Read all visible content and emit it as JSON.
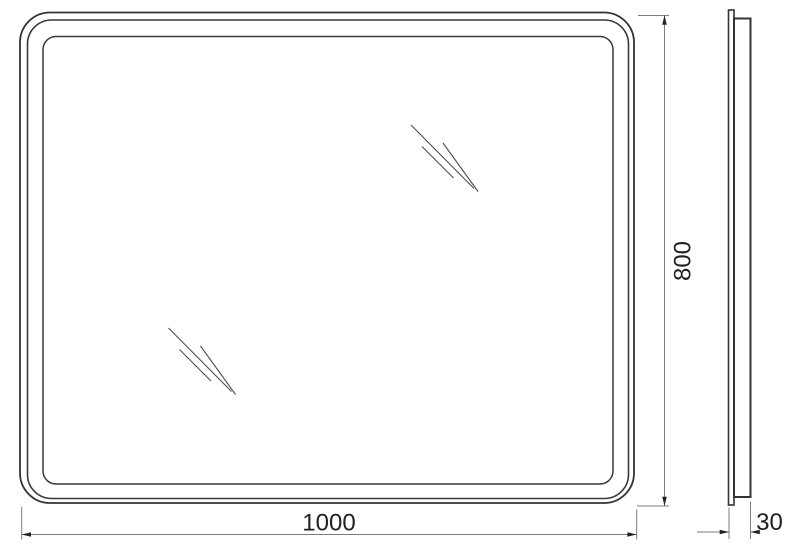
{
  "drawing": {
    "dimension_labels": {
      "width": "1000",
      "height": "800",
      "depth": "30"
    },
    "colors": {
      "background": "#ffffff",
      "outline": "#333333",
      "dimension_lines": "#7d7d7d",
      "label_text": "#1f1f1f"
    }
  }
}
